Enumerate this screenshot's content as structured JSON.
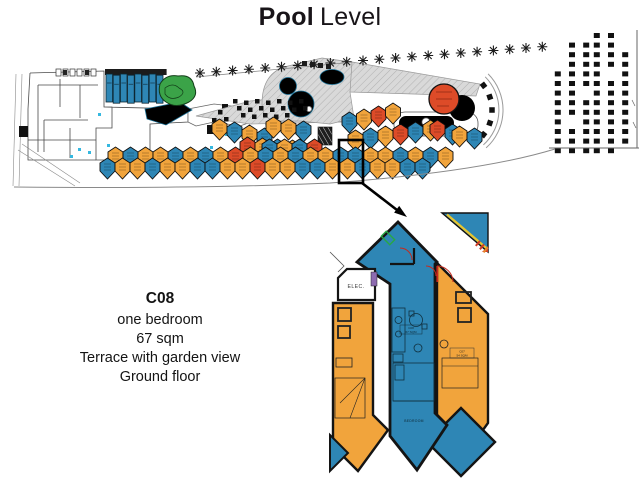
{
  "title": {
    "bold": "Pool",
    "regular": "Level"
  },
  "unit_info": {
    "code": "C08",
    "lines": [
      "one bedroom",
      "67 sqm",
      "Terrace with garden view",
      "Ground floor"
    ]
  },
  "detail_labels": {
    "elec": "ELEC.",
    "bedroom": "BEDROOM",
    "unit_tag": [
      "C08",
      "67 SQM"
    ],
    "neighbor_tag": [
      "C07",
      "54 SQM"
    ]
  },
  "colors": {
    "unit_orange": "#F1A43C",
    "unit_blue": "#2E86B5",
    "unit_red": "#DD4B28",
    "unit_green": "#3BA348",
    "pool": "#29A9E0",
    "deck": "#D6D6D6",
    "wall": "#141414",
    "highlight": "#000000",
    "accent_yellow": "#E6C52F",
    "accent_violet": "#8D6BB0"
  },
  "site_plan": {
    "unit_rows": [
      {
        "x": 212,
        "y": 119,
        "dx": 15,
        "dy": 3,
        "colors": "OBOB"
      },
      {
        "x": 240,
        "y": 137,
        "dx": 15,
        "dy": 1,
        "colors": "ROBO"
      },
      {
        "x": 266,
        "y": 117,
        "dx": 15,
        "dy": 2,
        "colors": "OOB"
      },
      {
        "x": 262,
        "y": 139,
        "dx": 15,
        "dy": 0,
        "colors": "BOBR"
      },
      {
        "x": 342,
        "y": 112,
        "dx": 14.5,
        "dy": -3,
        "colors": "BORO"
      },
      {
        "x": 348,
        "y": 130,
        "dx": 15,
        "dy": -2,
        "colors": "OBORBO"
      },
      {
        "x": 430,
        "y": 120,
        "dx": 15,
        "dy": 4,
        "colors": "RB"
      },
      {
        "x": 452,
        "y": 126,
        "dx": 15,
        "dy": 2,
        "colors": "OB"
      },
      {
        "x": 108,
        "y": 147,
        "dx": 15,
        "dy": 0,
        "colors": "OBOOBOBOROBOBOOBBOOBOBO"
      },
      {
        "x": 100,
        "y": 158,
        "dx": 15,
        "dy": 0,
        "colors": "BOOBOOBBOOROOBBOOBOOBB"
      }
    ],
    "blue_rowhouses": {
      "count": 8,
      "x0": 106,
      "y0": 74,
      "dx": 7.2,
      "w": 6.6,
      "h": 28
    },
    "trees": {
      "count": 22,
      "x0": 200,
      "y0": 73,
      "dx": 16.3,
      "dy": -1.25
    },
    "parking": {
      "x0": 556,
      "y0": 33,
      "dx": 13,
      "dy": 9.6,
      "rows": 13,
      "col_start": [
        4,
        1,
        1,
        0,
        0,
        2
      ],
      "col_end": [
        12,
        12,
        12,
        12,
        12,
        11
      ],
      "skips": [
        [
          2,
          6
        ],
        [
          4,
          4
        ],
        [
          1,
          9
        ]
      ]
    },
    "tables": {
      "x0": 233,
      "y0": 99,
      "rows": [
        7,
        7,
        5
      ],
      "extra": [
        [
          218,
          110
        ],
        [
          224,
          117
        ],
        [
          212,
          118
        ]
      ]
    },
    "cabanas": {
      "cx": 452,
      "cy": 110,
      "r": 40,
      "angles_deg": [
        -38,
        -19,
        0,
        19,
        38,
        55
      ]
    }
  }
}
